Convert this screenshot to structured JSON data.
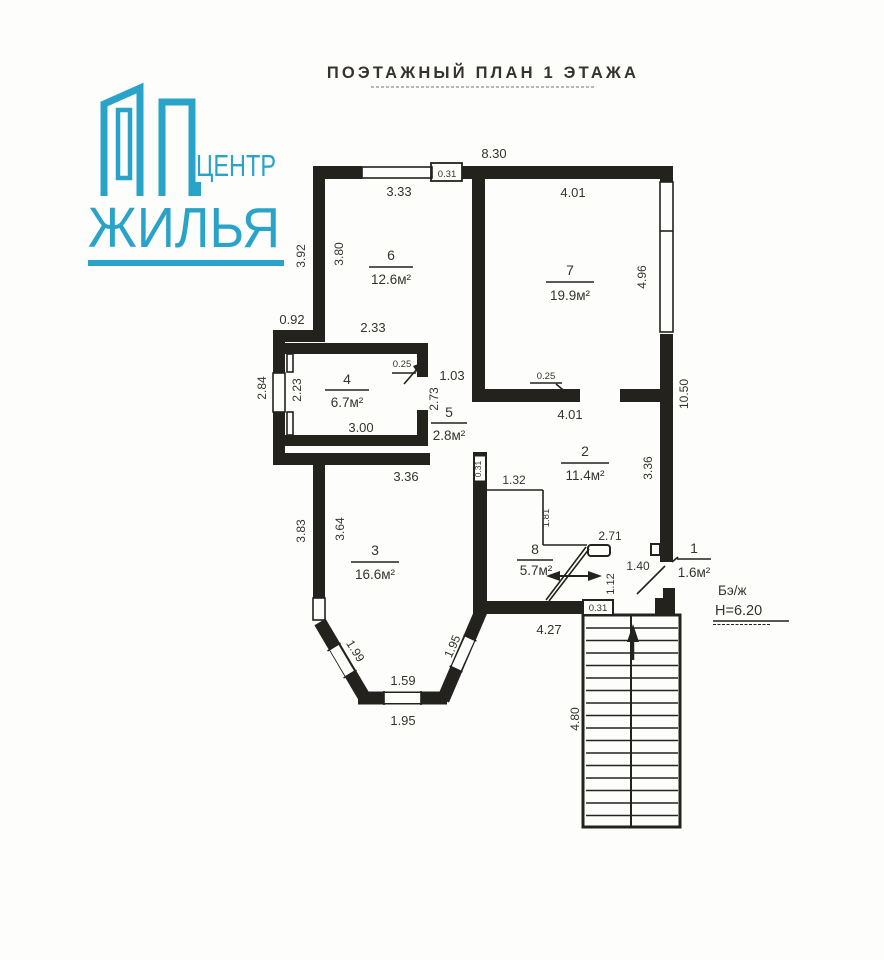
{
  "header": {
    "title": "ПОЭТАЖНЫЙ ПЛАН 1 ЭТАЖА"
  },
  "logo": {
    "line1": "ЦЕНТР",
    "line2": "ЖИЛЬЯ",
    "color": "#29a3c7"
  },
  "plan": {
    "rooms": [
      {
        "num": "6",
        "area": "12.6м²"
      },
      {
        "num": "7",
        "area": "19.9м²"
      },
      {
        "num": "4",
        "area": "6.7м²"
      },
      {
        "num": "5",
        "area": "2.8м²"
      },
      {
        "num": "2",
        "area": "11.4м²"
      },
      {
        "num": "3",
        "area": "16.6м²"
      },
      {
        "num": "8",
        "area": "5.7м²"
      },
      {
        "num": "1",
        "area": "1.6м²"
      }
    ],
    "dims": {
      "overall_top": "8.30",
      "top_wall_thickness": "0.31",
      "room6_width": "3.33",
      "room7_width": "4.01",
      "left_outer_height": "3.92",
      "room6_height": "3.80",
      "step_left": "0.92",
      "room4_top": "2.33",
      "bay4_outer": "2.84",
      "room4_height": "2.23",
      "closet_width": "1.03",
      "closet_nib": "0.25",
      "room5_height": "2.73",
      "room4_width": "3.00",
      "wall7_thickness": "0.25",
      "room7_bottom": "4.01",
      "right_window": "4.96",
      "right_total": "10.50",
      "room3_top": "3.36",
      "room2_height": "3.36",
      "room3_left_outer": "3.83",
      "room3_height": "3.64",
      "divider_thickness": "0.31",
      "part_132": "1.32",
      "part_181": "1.81",
      "part_271": "2.71",
      "entry_140": "1.40",
      "entry_112": "1.12",
      "south_wall_thickness": "0.31",
      "south_width": "4.27",
      "bay_left": "1.99",
      "bay_bottom_inner": "1.59",
      "bay_bottom_outer": "1.95",
      "bay_right": "1.95",
      "stairs_length": "4.80"
    },
    "notes": {
      "construction": "Бэ/ж",
      "height": "Н=6.20"
    }
  }
}
